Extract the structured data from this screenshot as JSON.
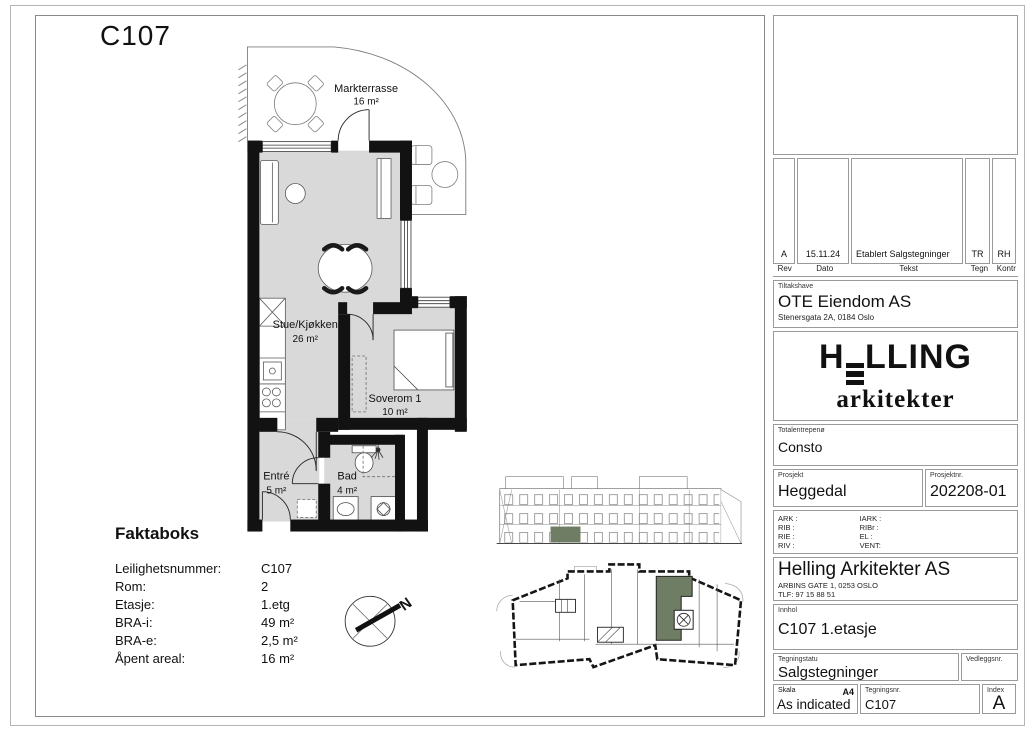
{
  "drawing": {
    "title": "C107",
    "rooms": [
      {
        "name": "Markterrasse",
        "area": "16 m²"
      },
      {
        "name": "Stue/Kjøkken",
        "area": "26 m²"
      },
      {
        "name": "Soverom 1",
        "area": "10 m²"
      },
      {
        "name": "Entré",
        "area": "5 m²"
      },
      {
        "name": "Bad",
        "area": "4 m²"
      }
    ],
    "compass_north": "N"
  },
  "faktaboks": {
    "heading": "Faktaboks",
    "rows": [
      {
        "label": "Leilighetsnummer:",
        "value": "C107"
      },
      {
        "label": "Rom:",
        "value": "2"
      },
      {
        "label": "Etasje:",
        "value": "1.etg"
      },
      {
        "label": "BRA-i:",
        "value": "49 m²"
      },
      {
        "label": "BRA-e:",
        "value": "2,5 m²"
      },
      {
        "label": "Åpent areal:",
        "value": "16 m²"
      }
    ]
  },
  "titleblock": {
    "revision": {
      "headers": [
        "Rev",
        "Dato",
        "Tekst",
        "Tegn",
        "Kontr"
      ],
      "row": {
        "rev": "A",
        "dato": "15.11.24",
        "tekst": "Etablert Salgstegninger",
        "tegn": "TR",
        "kontr": "RH"
      }
    },
    "client": {
      "label": "Tiltakshave",
      "name": "OTE Eiendom AS",
      "address": "Stenersgata 2A, 0184 Oslo"
    },
    "logo": {
      "pre": "H",
      "rest": "LLING",
      "sub": "arkitekter"
    },
    "contractor": {
      "label": "Totalentrepenø",
      "name": "Consto"
    },
    "project": {
      "label": "Prosjekt",
      "name": "Heggedal"
    },
    "project_no": {
      "label": "Prosjektnr.",
      "value": "202208-01"
    },
    "consultants": {
      "left": [
        "ARK :",
        "RIB :",
        "RIE :",
        "RIV :"
      ],
      "right": [
        "IARK :",
        "RIBr :",
        "EL :",
        "VENT:"
      ]
    },
    "architect": {
      "name": "Helling Arkitekter AS",
      "address": "ARBINS GATE 1, 0253 OSLO",
      "phone": "TLF: 97 15 88 51"
    },
    "content": {
      "label": "Innhol",
      "value": "C107 1.etasje"
    },
    "status": {
      "label": "Tegningstatu",
      "value": "Salgstegninger"
    },
    "attachment": {
      "label": "Vedleggsnr."
    },
    "scale": {
      "label": "Skala",
      "format": "A4",
      "value": "As indicated"
    },
    "drawing_no": {
      "label": "Tegningsnr.",
      "value": "C107"
    },
    "index": {
      "label": "Index",
      "value": "A"
    }
  },
  "colors": {
    "unit_highlight": "#6e7d64",
    "floor_gray": "#d9d9d9",
    "wall": "#121212"
  }
}
